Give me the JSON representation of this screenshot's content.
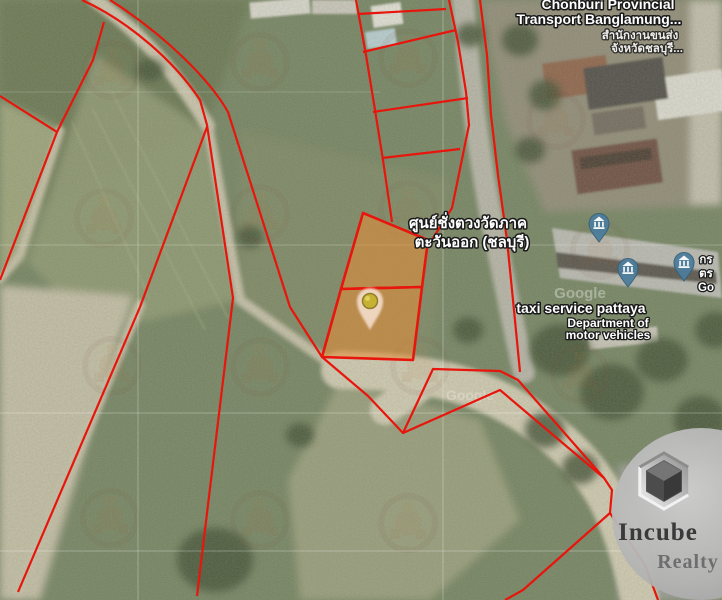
{
  "map": {
    "attribution_watermark": "Google",
    "labels": {
      "transport_office_en1": "Chonburi Provincial",
      "transport_office_en2": "Transport Banglamung...",
      "transport_office_th1": "สำนักงานขนส่ง",
      "transport_office_th2": "จังหวัดชลบุรี...",
      "weights_measures_th1": "ศูนย์ชั่งตวงวัดภาค",
      "weights_measures_th2": "ตะวันออก (ชลบุรี)",
      "taxi_service": "taxi service pattaya",
      "dmv_line1": "Department of",
      "dmv_line2": "motor vehicles",
      "edge_clipped_1": "กร",
      "edge_clipped_2": "ตร",
      "edge_clipped_3": "Go"
    },
    "colors": {
      "parcel_highlight": "#e88c34",
      "boundary": "#e8150c",
      "marker_blue": "#4d7d9b",
      "pin_dot": "#c6b133"
    }
  },
  "branding": {
    "logo_line1": "Incube",
    "logo_line2": "Realty"
  }
}
